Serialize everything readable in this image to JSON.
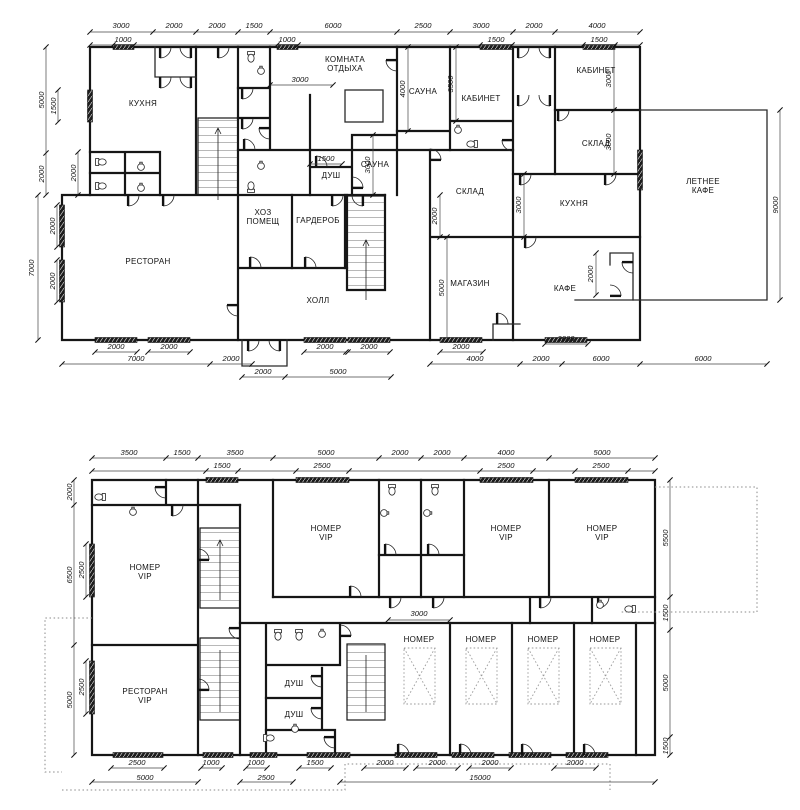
{
  "floor1": {
    "rooms": [
      {
        "text": "КУХНЯ",
        "x": 143,
        "y": 106
      },
      {
        "lines": [
          "КОМНАТА",
          "ОТДЫХА"
        ],
        "text": "КОМНАТА ОТДЫХА",
        "x": 345,
        "y": 62
      },
      {
        "text": "САУНА",
        "x": 423,
        "y": 94
      },
      {
        "text": "КАБИНЕТ",
        "x": 481,
        "y": 101
      },
      {
        "text": "САУНА",
        "x": 375,
        "y": 167
      },
      {
        "text": "ДУШ",
        "x": 331,
        "y": 178
      },
      {
        "text": "КАБИНЕТ",
        "x": 596,
        "y": 73
      },
      {
        "text": "СКЛАД",
        "x": 596,
        "y": 146
      },
      {
        "text": "КУХНЯ",
        "x": 574,
        "y": 206
      },
      {
        "text": "СКЛАД",
        "x": 470,
        "y": 194
      },
      {
        "text": "МАГАЗИН",
        "x": 470,
        "y": 286
      },
      {
        "text": "КАФЕ",
        "x": 565,
        "y": 291
      },
      {
        "lines": [
          "ЛЕТНЕЕ",
          "КАФЕ"
        ],
        "text": "ЛЕТНЕЕ КАФЕ",
        "x": 703,
        "y": 184
      },
      {
        "text": "РЕСТОРАН",
        "x": 148,
        "y": 264
      },
      {
        "lines": [
          "ХОЗ",
          "ПОМЕЩ"
        ],
        "text": "ХОЗ ПОМЕЩ",
        "x": 263,
        "y": 215
      },
      {
        "text": "ГАРДЕРОБ",
        "x": 318,
        "y": 223
      },
      {
        "text": "ХОЛЛ",
        "x": 318,
        "y": 303
      }
    ],
    "dims": [
      {
        "text": "3000",
        "x": 121,
        "y": 28
      },
      {
        "text": "2000",
        "x": 174,
        "y": 28
      },
      {
        "text": "2000",
        "x": 217,
        "y": 28
      },
      {
        "text": "1500",
        "x": 254,
        "y": 28
      },
      {
        "text": "6000",
        "x": 333,
        "y": 28
      },
      {
        "text": "2500",
        "x": 423,
        "y": 28
      },
      {
        "text": "3000",
        "x": 481,
        "y": 28
      },
      {
        "text": "2000",
        "x": 534,
        "y": 28
      },
      {
        "text": "4000",
        "x": 597,
        "y": 28
      },
      {
        "text": "1000",
        "x": 123,
        "y": 42
      },
      {
        "text": "1000",
        "x": 287,
        "y": 42
      },
      {
        "text": "1500",
        "x": 496,
        "y": 42
      },
      {
        "text": "1500",
        "x": 599,
        "y": 42
      },
      {
        "text": "3000",
        "x": 300,
        "y": 82
      },
      {
        "text": "1500",
        "x": 326,
        "y": 161
      },
      {
        "text": "5000",
        "x": 44,
        "y": 100,
        "rot": true
      },
      {
        "text": "1500",
        "x": 56,
        "y": 106,
        "rot": true
      },
      {
        "text": "2000",
        "x": 44,
        "y": 174,
        "rot": true
      },
      {
        "text": "2000",
        "x": 76,
        "y": 173,
        "rot": true
      },
      {
        "text": "7000",
        "x": 34,
        "y": 268,
        "rot": true
      },
      {
        "text": "2000",
        "x": 55,
        "y": 226,
        "rot": true
      },
      {
        "text": "2000",
        "x": 55,
        "y": 281,
        "rot": true
      },
      {
        "text": "4000",
        "x": 405,
        "y": 89,
        "rot": true
      },
      {
        "text": "3500",
        "x": 453,
        "y": 84,
        "rot": true
      },
      {
        "text": "3000",
        "x": 611,
        "y": 79,
        "rot": true
      },
      {
        "text": "3000",
        "x": 611,
        "y": 142,
        "rot": true
      },
      {
        "text": "3000",
        "x": 521,
        "y": 205,
        "rot": true
      },
      {
        "text": "3000",
        "x": 370,
        "y": 165,
        "rot": true
      },
      {
        "text": "2000",
        "x": 437,
        "y": 216,
        "rot": true
      },
      {
        "text": "5000",
        "x": 444,
        "y": 288,
        "rot": true
      },
      {
        "text": "2000",
        "x": 593,
        "y": 274,
        "rot": true
      },
      {
        "text": "9000",
        "x": 778,
        "y": 205,
        "rot": true
      },
      {
        "text": "2000",
        "x": 116,
        "y": 349
      },
      {
        "text": "2000",
        "x": 169,
        "y": 349
      },
      {
        "text": "7000",
        "x": 136,
        "y": 361
      },
      {
        "text": "2000",
        "x": 231,
        "y": 361
      },
      {
        "text": "2000",
        "x": 325,
        "y": 349
      },
      {
        "text": "2000",
        "x": 369,
        "y": 349
      },
      {
        "text": "2000",
        "x": 263,
        "y": 374
      },
      {
        "text": "5000",
        "x": 338,
        "y": 374
      },
      {
        "text": "2000",
        "x": 461,
        "y": 349
      },
      {
        "text": "4000",
        "x": 475,
        "y": 361
      },
      {
        "text": "2000",
        "x": 541,
        "y": 361
      },
      {
        "text": "2000",
        "x": 566,
        "y": 341
      },
      {
        "text": "6000",
        "x": 601,
        "y": 361
      },
      {
        "text": "6000",
        "x": 703,
        "y": 361
      }
    ]
  },
  "floor2": {
    "rooms": [
      {
        "lines": [
          "НОМЕР",
          "VIP"
        ],
        "text": "НОМЕР VIP",
        "x": 145,
        "y": 570
      },
      {
        "lines": [
          "НОМЕР",
          "VIP"
        ],
        "text": "НОМЕР VIP",
        "x": 326,
        "y": 531
      },
      {
        "lines": [
          "НОМЕР",
          "VIP"
        ],
        "text": "НОМЕР VIP",
        "x": 506,
        "y": 531
      },
      {
        "lines": [
          "НОМЕР",
          "VIP"
        ],
        "text": "НОМЕР VIP",
        "x": 602,
        "y": 531
      },
      {
        "lines": [
          "РЕСТОРАН",
          "VIP"
        ],
        "text": "РЕСТОРАН VIP",
        "x": 145,
        "y": 694
      },
      {
        "text": "ДУШ",
        "x": 294,
        "y": 686
      },
      {
        "text": "ДУШ",
        "x": 294,
        "y": 717
      },
      {
        "text": "НОМЕР",
        "x": 419,
        "y": 642
      },
      {
        "text": "НОМЕР",
        "x": 481,
        "y": 642
      },
      {
        "text": "НОМЕР",
        "x": 543,
        "y": 642
      },
      {
        "text": "НОМЕР",
        "x": 605,
        "y": 642
      }
    ],
    "dims": [
      {
        "text": "3500",
        "x": 129,
        "y": 455
      },
      {
        "text": "1500",
        "x": 182,
        "y": 455
      },
      {
        "text": "3500",
        "x": 235,
        "y": 455
      },
      {
        "text": "5000",
        "x": 326,
        "y": 455
      },
      {
        "text": "2000",
        "x": 400,
        "y": 455
      },
      {
        "text": "2000",
        "x": 442,
        "y": 455
      },
      {
        "text": "4000",
        "x": 506,
        "y": 455
      },
      {
        "text": "5000",
        "x": 602,
        "y": 455
      },
      {
        "text": "1500",
        "x": 222,
        "y": 468
      },
      {
        "text": "2500",
        "x": 322,
        "y": 468
      },
      {
        "text": "2500",
        "x": 506,
        "y": 468
      },
      {
        "text": "2500",
        "x": 601,
        "y": 468
      },
      {
        "text": "2000",
        "x": 72,
        "y": 492,
        "rot": true
      },
      {
        "text": "6500",
        "x": 72,
        "y": 575,
        "rot": true
      },
      {
        "text": "5000",
        "x": 72,
        "y": 700,
        "rot": true
      },
      {
        "text": "2500",
        "x": 84,
        "y": 570,
        "rot": true
      },
      {
        "text": "2500",
        "x": 84,
        "y": 687,
        "rot": true
      },
      {
        "text": "5500",
        "x": 668,
        "y": 538,
        "rot": true
      },
      {
        "text": "1500",
        "x": 668,
        "y": 613,
        "rot": true
      },
      {
        "text": "5000",
        "x": 668,
        "y": 683,
        "rot": true
      },
      {
        "text": "1500",
        "x": 668,
        "y": 746,
        "rot": true
      },
      {
        "text": "3000",
        "x": 419,
        "y": 616
      },
      {
        "text": "2500",
        "x": 137,
        "y": 765
      },
      {
        "text": "1000",
        "x": 211,
        "y": 765
      },
      {
        "text": "1000",
        "x": 256,
        "y": 765
      },
      {
        "text": "1500",
        "x": 315,
        "y": 765
      },
      {
        "text": "2000",
        "x": 385,
        "y": 765
      },
      {
        "text": "2000",
        "x": 437,
        "y": 765
      },
      {
        "text": "2000",
        "x": 490,
        "y": 765
      },
      {
        "text": "2000",
        "x": 575,
        "y": 765
      },
      {
        "text": "5000",
        "x": 145,
        "y": 780
      },
      {
        "text": "2500",
        "x": 266,
        "y": 780
      },
      {
        "text": "15000",
        "x": 480,
        "y": 780
      }
    ]
  }
}
